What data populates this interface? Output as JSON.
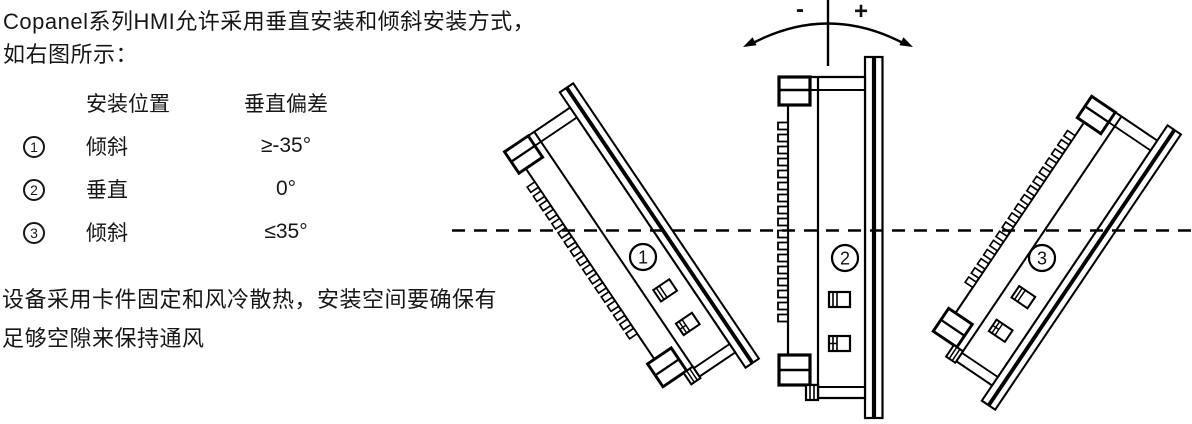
{
  "intro": {
    "line1": "Copanel系列HMI允许采用垂直安装和倾斜安装方式，",
    "line2": "如右图所示："
  },
  "table": {
    "headers": {
      "position": "安装位置",
      "deviation": "垂直偏差"
    },
    "rows": [
      {
        "num": "1",
        "position": "倾斜",
        "deviation": "≥-35°"
      },
      {
        "num": "2",
        "position": "垂直",
        "deviation": "0°"
      },
      {
        "num": "3",
        "position": "倾斜",
        "deviation": "≤35°"
      }
    ]
  },
  "note": {
    "line1": "设备采用卡件固定和风冷散热，安装空间要确保有",
    "line2": "足够空隙来保持通风"
  },
  "diagram": {
    "minus_label": "-",
    "plus_label": "+",
    "colors": {
      "line": "#000000",
      "text": "#171717"
    },
    "panels": [
      {
        "num": "1",
        "rotation": -34,
        "scale": 0.92,
        "cx": 626,
        "cy": 248,
        "label_x": 643,
        "label_y": 257
      },
      {
        "num": "2",
        "rotation": 0,
        "scale": 1,
        "cx": 830,
        "cy": 237.5,
        "label_x": 845,
        "label_y": 258
      },
      {
        "num": "3",
        "rotation": 34,
        "scale": 0.92,
        "cx": 1048,
        "cy": 245,
        "label_x": 1042,
        "label_y": 258
      }
    ]
  }
}
